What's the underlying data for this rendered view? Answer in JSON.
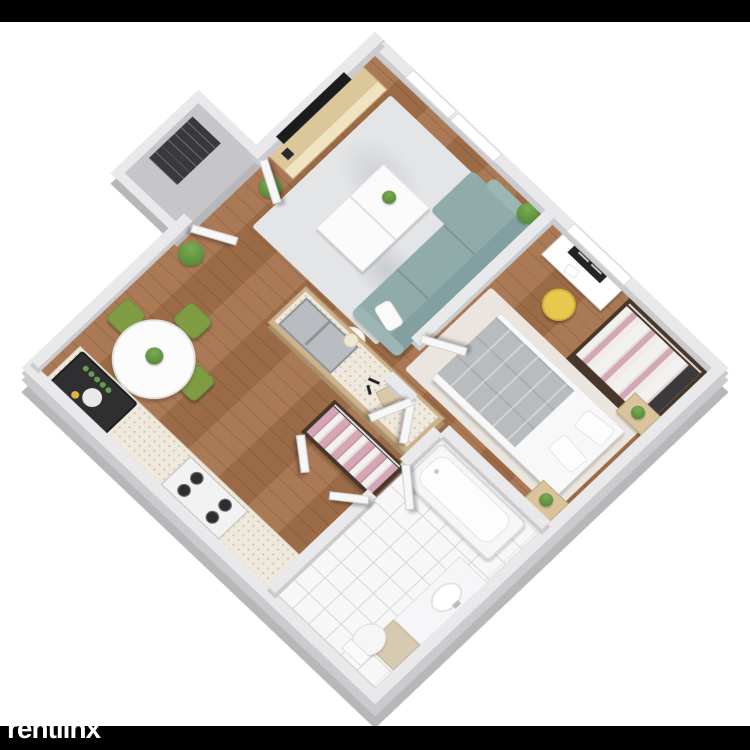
{
  "page": {
    "background": "#ffffff",
    "top_bar_color": "#000000",
    "bottom_bar_color": "#000000"
  },
  "watermark": {
    "text": "rentlinx",
    "mark": "®",
    "color": "#ffffff"
  },
  "floor_plan": {
    "view": "3d-isometric-apartment-floor-plan",
    "labels": {
      "living_room": "Living room",
      "dining_area": "Dining area",
      "kitchen": "Kitchen",
      "bedroom": "Bedroom",
      "bathroom": "Bathroom",
      "closet": "Closet",
      "entry": "Entry",
      "tv": "Wall-mounted TV",
      "tv_console": "TV console",
      "couch": "Teal sofa",
      "coffee_table": "Coffee tables",
      "dining_table": "Round dining table",
      "dining_chairs": "Green dining chairs",
      "island": "Kitchen island with sink",
      "stove": "Gas stove",
      "fridge": "Refrigerator",
      "desk": "Desk with monitor",
      "desk_chair": "Yellow desk chair",
      "bed": "Double bed",
      "wardrobe": "Open wardrobe with clothes",
      "bathtub": "Bathtub",
      "toilet": "Toilet",
      "vanity": "Vanity sink"
    },
    "colors": {
      "page_bg": "#ffffff",
      "wall": "#e9e9eb",
      "wall_shade": "#b7b7b9",
      "wall_shade2": "#cbcbcd",
      "floor_wood": "#a5714a",
      "tile": "#f7f7f8",
      "tile_line": "#d6d6d8",
      "rug": "#e4e5e7",
      "couch": "#8fabaa",
      "couch_dark": "#82a09f",
      "coffee_table": "#fbfbfb",
      "tv": "#1c1c1e",
      "console_wood": "#dcc79b",
      "plant": "#4e7d33",
      "plant_light": "#79ad52",
      "dining_chair": "#7f9c43",
      "table_white": "#fcfcfc",
      "counter_top": "#efe9dd",
      "counter_speck": "#cfc4ae",
      "island_wood": "#cdb28b",
      "steel": "#b9bdc1",
      "stove_burner": "#2e2e30",
      "fridge": "#2f2f31",
      "desk": "#ffffff",
      "monitor": "#232325",
      "chair_yellow": "#e9c84e",
      "bed": "#f8f8f8",
      "blanket": "#b9bcbf",
      "bed_rug": "#eae5df",
      "nightstand": "#d9c49c",
      "closet_floor": "#47362a",
      "clothes_pink": "#d5a7b5",
      "clothes_white": "#f3f1ef",
      "vanity_beige": "#d8cab1",
      "fixture": "#f6f6f8",
      "door": "#f7f7f8",
      "vestibule_floor": "#c6c6c8",
      "shelf_dark": "#39393b",
      "window": "#ffffff"
    }
  }
}
